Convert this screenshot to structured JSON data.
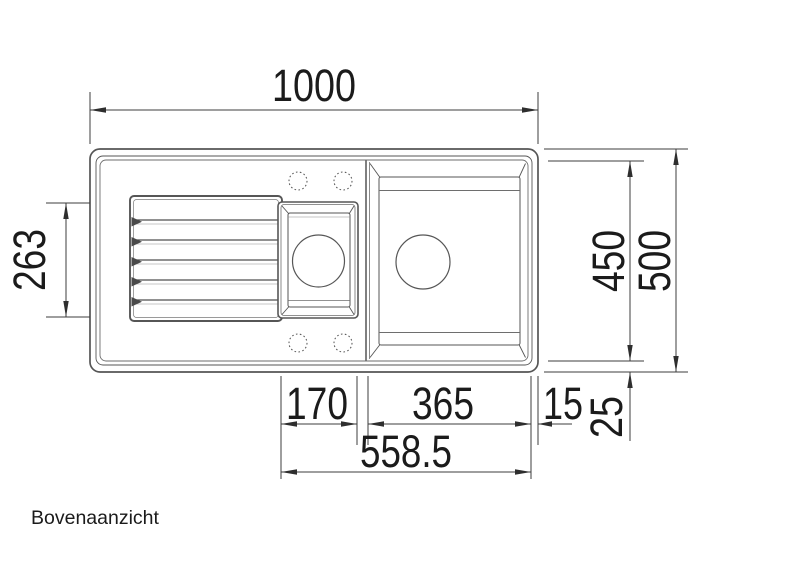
{
  "view_label": "Bovenaanzicht",
  "dimensions": {
    "total_width_mm": "1000",
    "drainboard_section_mm": "263",
    "bowl_depth_mm": "450",
    "total_depth_mm": "500",
    "small_bowl_width_mm": "170",
    "main_bowl_width_mm": "365",
    "edge_offset_mm": "15",
    "rim_offset_mm": "25",
    "cutout_width_mm": "558.5"
  },
  "colors": {
    "background": "#ffffff",
    "outline": "#565656",
    "outline_light": "#6e6e6e",
    "dimension_line": "#3d3d3d",
    "text": "#1b1b1b"
  }
}
